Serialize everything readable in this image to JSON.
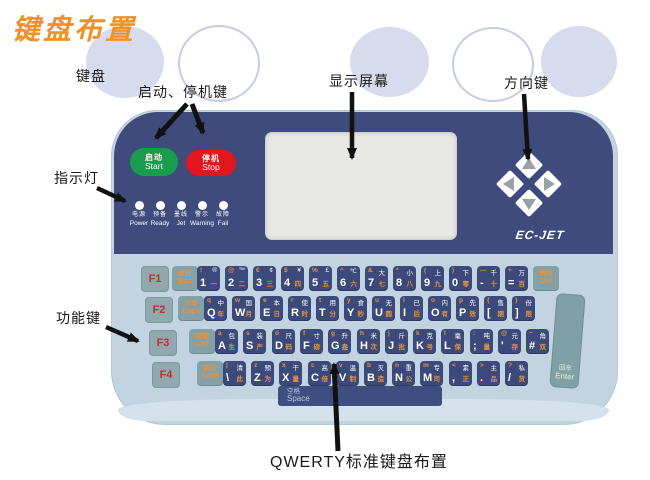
{
  "title": "键盘布置",
  "labels": {
    "keyboard": "键盘",
    "start_stop": "启动、停机键",
    "display": "显示屏幕",
    "direction": "方向键",
    "indicator": "指示灯",
    "function": "功能键",
    "qwerty": "QWERTY标准键盘布置"
  },
  "device": {
    "brand": "EC-JET",
    "start_button": {
      "zh": "启动",
      "en": "Start"
    },
    "stop_button": {
      "zh": "停机",
      "en": "Stop"
    },
    "indicators": [
      {
        "zh": "电源",
        "en": "Power"
      },
      {
        "zh": "预备",
        "en": "Ready"
      },
      {
        "zh": "墨线",
        "en": "Jet"
      },
      {
        "zh": "警示",
        "en": "Warning"
      },
      {
        "zh": "故障",
        "en": "Fail"
      }
    ],
    "direction_keys": [
      "up",
      "left",
      "right",
      "down"
    ],
    "keyboard": {
      "function_keys": [
        "F1",
        "F2",
        "F3",
        "F4"
      ],
      "space": {
        "zh": "空格",
        "en": "Space"
      },
      "enter": {
        "zh": "回车",
        "en": "Enter"
      },
      "rows": [
        {
          "mod": {
            "zh": "返回",
            "en": "Esc"
          },
          "keys": [
            [
              "!",
              "®",
              "1",
              "一"
            ],
            [
              "@",
              "™",
              "2",
              "二"
            ],
            [
              "€",
              "¢",
              "3",
              "三"
            ],
            [
              "$",
              "¥",
              "4",
              "四"
            ],
            [
              "%",
              "£",
              "5",
              "五"
            ],
            [
              "^",
              "℃",
              "6",
              "六"
            ],
            [
              "&",
              "大",
              "7",
              "七"
            ],
            [
              "*",
              "小",
              "8",
              "八"
            ],
            [
              "(",
              "上",
              "9",
              "九"
            ],
            [
              ")",
              "下",
              "0",
              "零"
            ],
            [
              "—",
              "千",
              "-",
              "十"
            ],
            [
              "+",
              "万",
              "=",
              "百"
            ]
          ],
          "end": {
            "zh": "删除",
            "en": "Del"
          }
        },
        {
          "mod": {
            "zh": "大写",
            "en": "Caps"
          },
          "keys": [
            [
              "q",
              "中",
              "Q",
              "年"
            ],
            [
              "w",
              "国",
              "W",
              "月"
            ],
            [
              "e",
              "本",
              "E",
              "日"
            ],
            [
              "r",
              "使",
              "R",
              "时"
            ],
            [
              "t",
              "用",
              "T",
              "分"
            ],
            [
              "y",
              "食",
              "Y",
              "秒"
            ],
            [
              "u",
              "无",
              "U",
              "圆"
            ],
            [
              "i",
              "已",
              "I",
              "后"
            ],
            [
              "o",
              "内",
              "O",
              "有"
            ],
            [
              "p",
              "先",
              "P",
              "效"
            ],
            [
              "{",
              "售",
              "[",
              "期"
            ],
            [
              "}",
              "份",
              "]",
              "限"
            ]
          ]
        },
        {
          "mod": {
            "zh": "控制",
            "en": "Ctrl"
          },
          "keys": [
            [
              "a",
              "包",
              "A",
              "生"
            ],
            [
              "s",
              "装",
              "S",
              "产"
            ],
            [
              "d",
              "尺",
              "D",
              "码"
            ],
            [
              "f",
              "寸",
              "F",
              "磅"
            ],
            [
              "g",
              "升",
              "G",
              "盎"
            ],
            [
              "h",
              "米",
              "H",
              "次"
            ],
            [
              "j",
              "斤",
              "J",
              "批"
            ],
            [
              "k",
              "克",
              "K",
              "号"
            ],
            [
              "l",
              "毫",
              "L",
              "保"
            ],
            [
              ":",
              "吨",
              ";",
              "量"
            ],
            [
              "@",
              "元",
              "'",
              "存"
            ],
            [
              "~",
              "角",
              "#",
              "双"
            ]
          ]
        },
        {
          "mod": {
            "zh": "移位",
            "en": "Shift"
          },
          "keys": [
            [
              "|",
              "清",
              "\\",
              "此"
            ],
            [
              "z",
              "预",
              "Z",
              "为"
            ],
            [
              "x",
              "干",
              "X",
              "量"
            ],
            [
              "c",
              "高",
              "C",
              "倍"
            ],
            [
              "v",
              "温",
              "V",
              "制"
            ],
            [
              "b",
              "灭",
              "B",
              "造"
            ],
            [
              "n",
              "重",
              "N",
              "公"
            ],
            [
              "m",
              "专",
              "M",
              "司"
            ],
            [
              "<",
              "素",
              ",",
              "正"
            ],
            [
              ">",
              "主",
              ".",
              "品"
            ],
            [
              "?",
              "私",
              "/",
              "货"
            ]
          ]
        }
      ]
    }
  },
  "colors": {
    "title_orange": "#ef9223",
    "panel_navy": "#3e4b7c",
    "shell_blue": "#c2d4e1",
    "shell_lip": "#d4e2eb",
    "key_navy": "#3b4a7b",
    "key_teal": "#84a1a8",
    "fkey_teal": "#8fa9ae",
    "fkey_text": "#c23127",
    "key_orange": "#e8923c",
    "start_green": "#199c4e",
    "stop_red": "#e2161f",
    "display_gray": "#e7e8e4",
    "circle_lavender": "#d8daed",
    "led_white": "#ffffff",
    "arrow_black": "#111111"
  }
}
